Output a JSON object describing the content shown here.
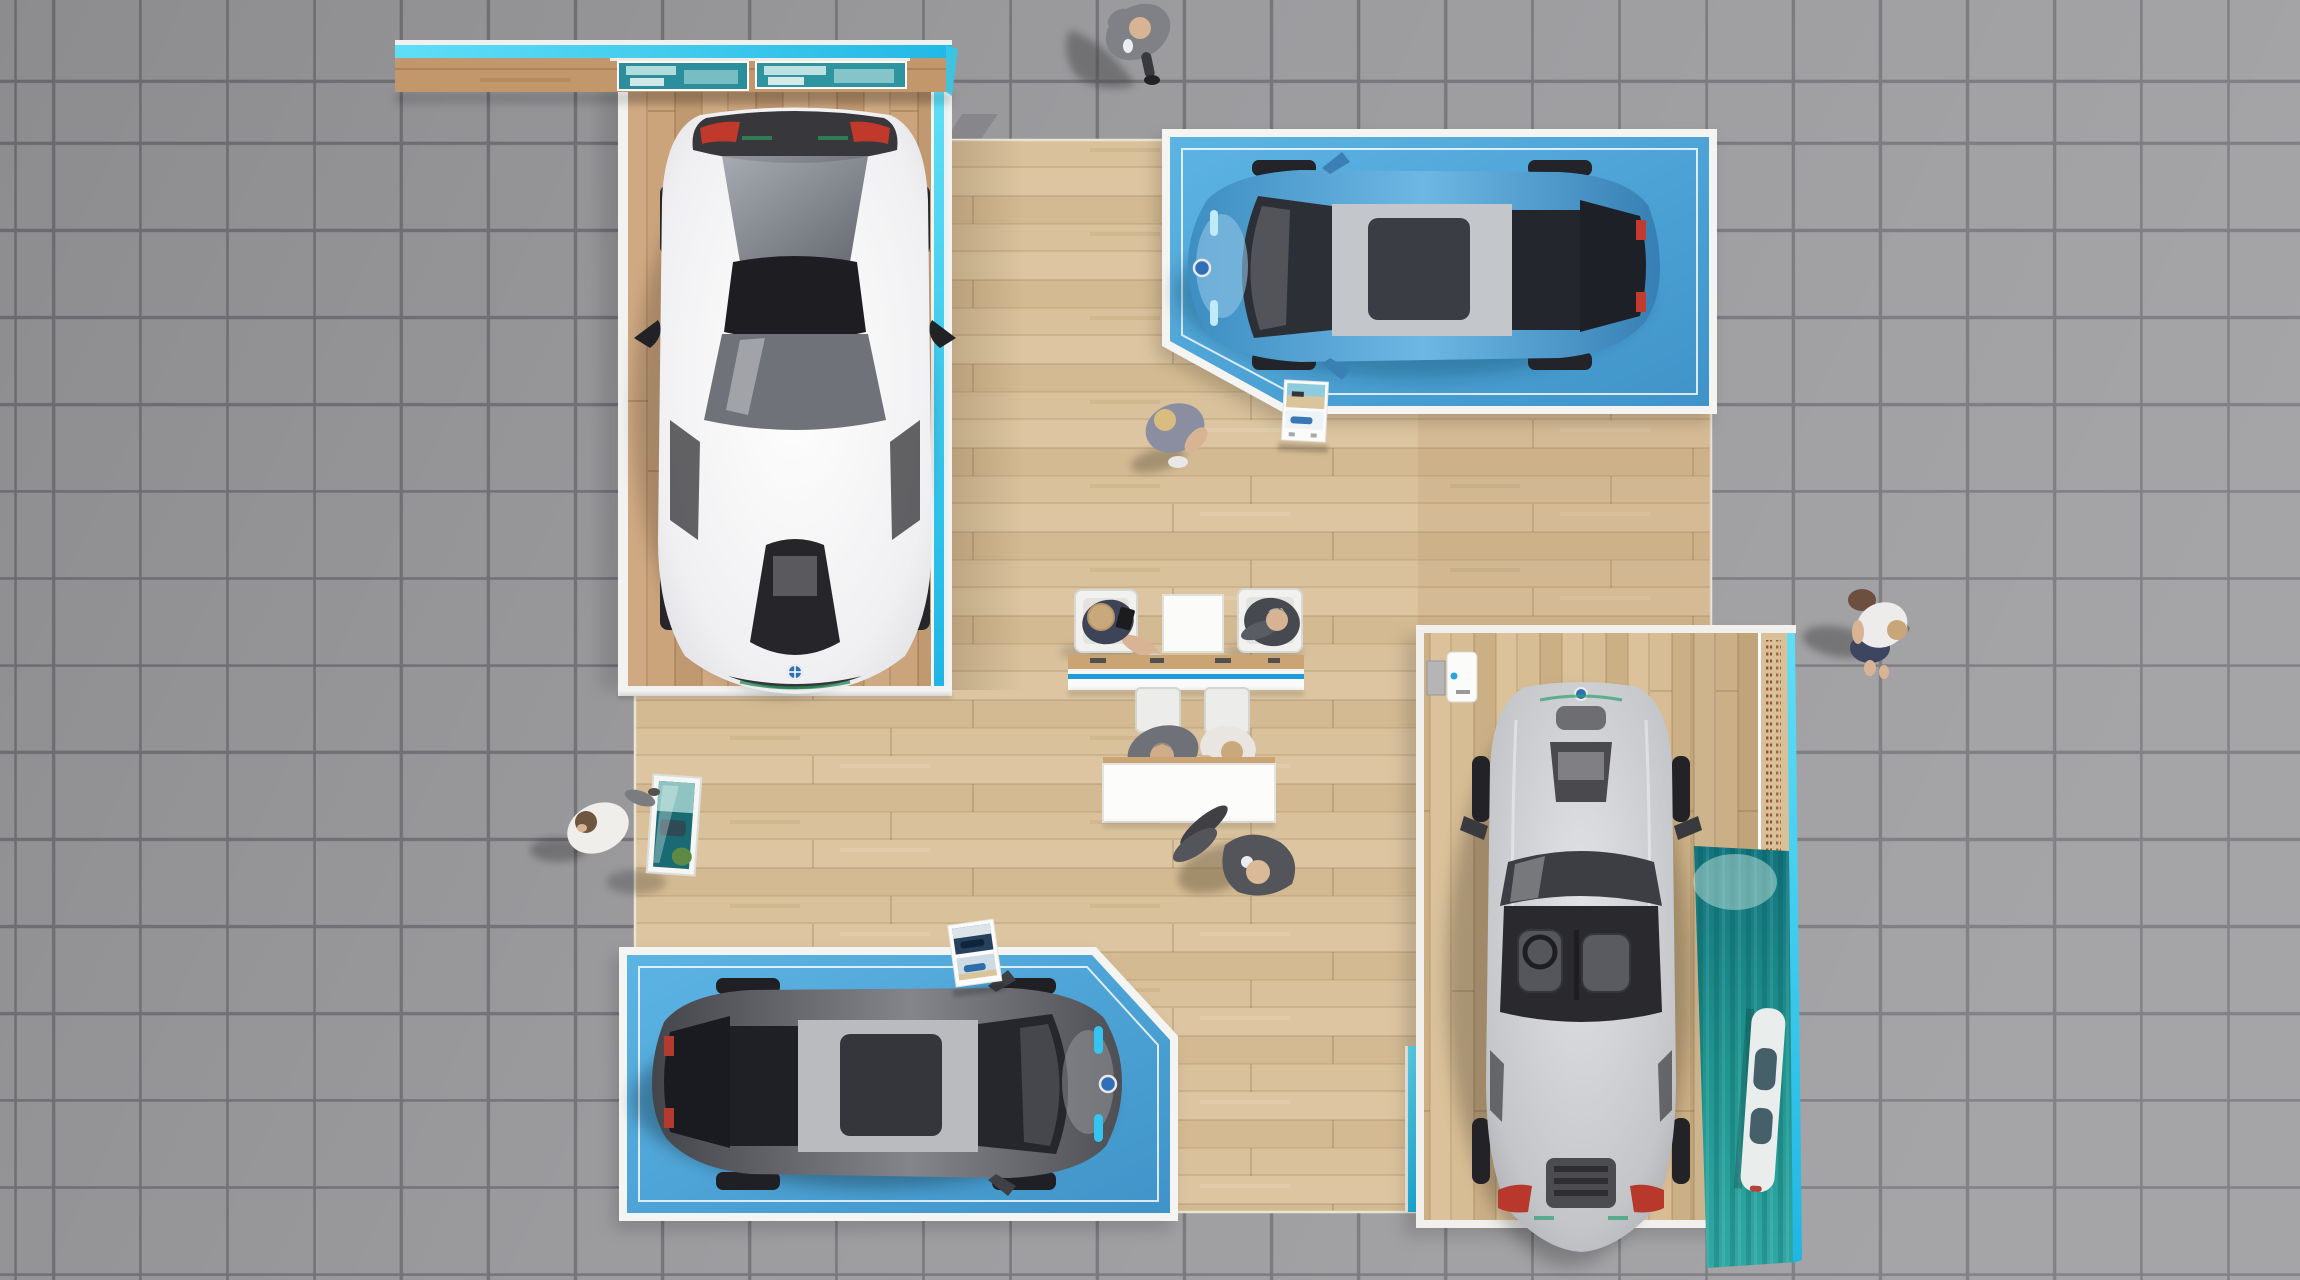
{
  "scene": {
    "label": "car exhibition stand viewed from directly above"
  },
  "colors": {
    "tile-fill": "#9c9c9f",
    "tile-grout": "#75757a",
    "wood-main": "#d8c09a",
    "wood-platform": "#c7a078",
    "wood-silver": "#d3b88d",
    "wood-header": "#c1976b",
    "platform-blue": "#4fa9db",
    "platform-blue-deep": "#3f93c8",
    "border-white": "#f2f2f0",
    "cyan-glow": "#3bcdef",
    "counter-stripe": "#1e9bd8",
    "ocean-teal-dark": "#12747e",
    "ocean-teal-light": "#2fa8a4",
    "wall-text-brown": "#823e1e",
    "car-white": "#f4f4f6",
    "car-blue": "#4a9fd4",
    "car-dark-gray": "#55565c",
    "car-silver": "#c7c9cc",
    "furniture-white": "#f6f6f4",
    "suit-dark": "#54555b",
    "suit-gray": "#808186",
    "skin": "#d8b494",
    "hair-blonde": "#d9bc80"
  },
  "platforms": [
    {
      "id": "white-coupe-platform-top-left",
      "floor": "wood",
      "edge": "cyan-glow-strip",
      "header": "canopy with two display screens"
    },
    {
      "id": "blue-hatchback-platform-top-right",
      "floor": "blue",
      "border": "white",
      "corner": "clipped bottom-left"
    },
    {
      "id": "gray-hatchback-platform-bottom-left",
      "floor": "blue",
      "border": "white",
      "corner": "clipped top-right"
    },
    {
      "id": "silver-roadster-platform-right",
      "floor": "wood",
      "wall": "graphic wall with vertical micro text and ocean artwork"
    }
  ],
  "cars": [
    {
      "id": "white-coupe",
      "body": "white",
      "facing": "down"
    },
    {
      "id": "blue-hatchback",
      "body": "blue",
      "facing": "left"
    },
    {
      "id": "gray-hatchback",
      "body": "dark-gray",
      "facing": "right"
    },
    {
      "id": "silver-roadster",
      "body": "silver",
      "facing": "up",
      "top": "open cockpit"
    }
  ],
  "furniture": {
    "armchairs": 2,
    "coffee_table": 1,
    "lounge_counter": 1,
    "stool_chairs": 2,
    "white_desk": 1,
    "brochure_kiosks": 2,
    "display_vitrine": 1,
    "charging_station": 1
  },
  "people": [
    {
      "id": "man-on-phone-top",
      "attire": "gray suit"
    },
    {
      "id": "blonde-woman-walking",
      "attire": "gray-violet dress"
    },
    {
      "id": "visitor-white-shirt-left",
      "attire": "white shirt, gray trousers"
    },
    {
      "id": "woman-with-bag-right",
      "attire": "white top, navy skirt, brown bag"
    },
    {
      "id": "seated-woman-armchair-left",
      "attire": "navy top, straw hat, tablet"
    },
    {
      "id": "seated-man-armchair-right",
      "attire": "dark suit"
    },
    {
      "id": "consultant-at-counter-left",
      "attire": "gray suit"
    },
    {
      "id": "customer-at-counter-right",
      "attire": "white top"
    },
    {
      "id": "standing-man-bottom-center",
      "attire": "dark suit"
    }
  ]
}
